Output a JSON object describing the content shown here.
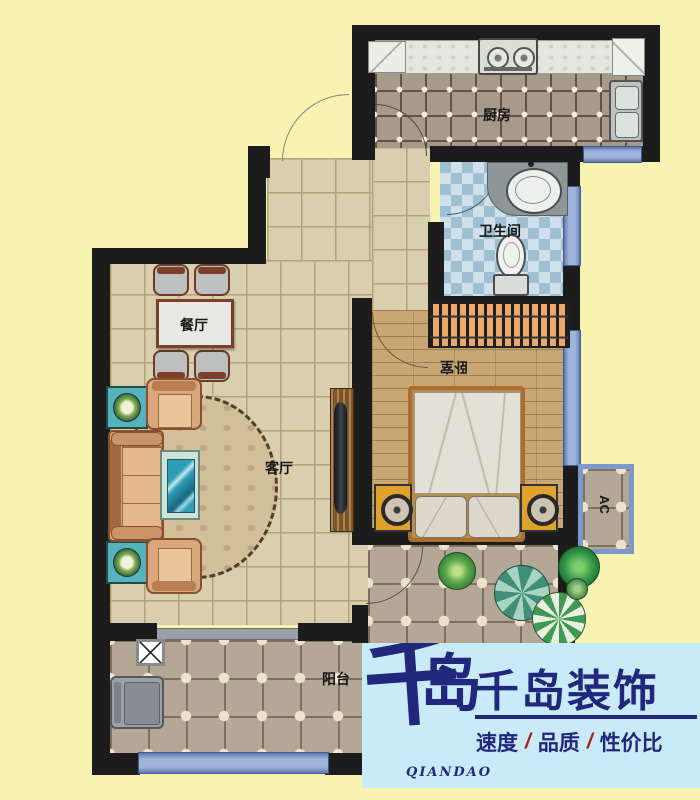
{
  "plan": {
    "background_color": "#F9F3B2",
    "wall_color": "#1c1c1c",
    "window_color": "#8ba3d4",
    "rooms": {
      "kitchen": {
        "label": "厨房"
      },
      "bathroom": {
        "label": "卫生间"
      },
      "dining": {
        "label": "餐厅"
      },
      "living": {
        "label": "客厅"
      },
      "bedroom": {
        "label": "卧室"
      },
      "balcony": {
        "label": "阳台"
      },
      "ac_platform": {
        "label": "AC"
      }
    }
  },
  "logo": {
    "background_color": "#C9EBF9",
    "navy": "#22277E",
    "slash_red": "#A3251F",
    "calligraphy_char1": "千",
    "calligraphy_char2": "岛",
    "romanized": "QIANDAO",
    "company": "千岛装饰",
    "tagline_parts": [
      "速度",
      "品质",
      "性价比"
    ],
    "slash": "/"
  }
}
